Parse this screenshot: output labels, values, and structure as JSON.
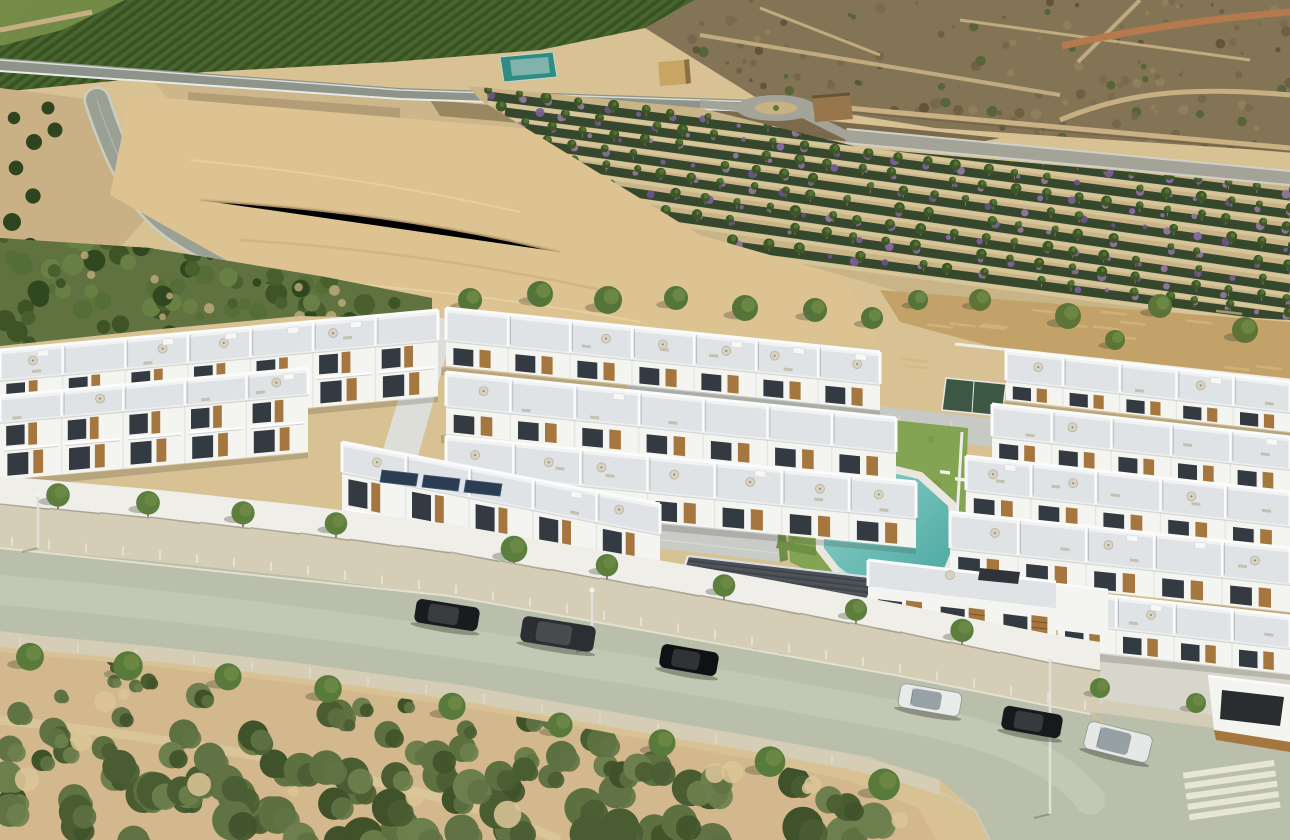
{
  "meta": {
    "kind": "aerial-architectural-render",
    "description": "Aerial 3D render of a new-build white villa residential complex with communal pool, bordered by a tree-lined street with parked cars, scrubland in the foreground, and farmland, a stone bridge and planted nursery rows in the background.",
    "width": 1290,
    "height": 840
  },
  "palette": {
    "ground": "#d8c193",
    "orchard": "#45602c",
    "orchard_row": "#36501f",
    "orchard_light": "#79904a",
    "scrub": "#847456",
    "scrub_dark": "#5e5138",
    "path": "#c6b083",
    "path_red": "#b5794e",
    "asphalt_hwy": "#8e948b",
    "bridge_stone": "#b39d76",
    "arch": "#3e3423",
    "riverbed": "#cdb68a",
    "wet_soil": "#6b5b3e",
    "road": "#9aa194",
    "road_edge": "#d9dcd4",
    "field": "#ddc391",
    "field_line": "#cfb27e",
    "row_green": "#35482d",
    "row_purple": "#8a6aa4",
    "row_purple2": "#6b5288",
    "row_path": "#d8c79b",
    "tree": "#55743a",
    "tree_dark": "#3c5626",
    "tree_light": "#6f8c46",
    "trunk": "#7a6a4e",
    "grove": "#5f7240",
    "meadow": "#c2a269",
    "court": "#3c5844",
    "teal_shed": "#2e8c82",
    "hut": "#c8a563",
    "hut2": "#96764a",
    "wall": "#f4f4f1",
    "roof": "#dfe3e6",
    "parapet": "#fbfbfa",
    "glass": "#333a41",
    "wood": "#a5773f",
    "umbrella": "#d8d2c3",
    "furniture": "#c6c0b0",
    "paving": "#c7cac4",
    "paving_light": "#dcdacf",
    "dark_roof": "#4b5056",
    "lawn": "#83a452",
    "lawn_dark": "#6f9144",
    "pool_deep": "#49a7a1",
    "pool_light": "#90d1ca",
    "pool_rim": "#e9e7df",
    "street": "#b9bfab",
    "street_light": "#cdd2bd",
    "sidewalk": "#d5cdb6",
    "curb": "#e4e0d0",
    "crosswalk": "#eae7d9",
    "sand": "#d2b88c",
    "bush": "#4a5c32",
    "bush2": "#5c7040",
    "bush3": "#3f5229",
    "solar": "#2b3d52",
    "shadow": "rgba(60,62,50,0.3)"
  },
  "scene": {
    "areas": [
      "orchard hillside",
      "highway embankment",
      "stone arch bridge",
      "dry riverbed",
      "northeast scrubland",
      "west access road",
      "sandy dirt field",
      "flower nursery rows",
      "north service road",
      "roundabout",
      "utility structures",
      "dry meadow",
      "padel court",
      "olive grove",
      "residential villa complex",
      "communal lawn",
      "swimming pool",
      "main street",
      "south scrubland"
    ],
    "swimming_pool": {
      "shape": "irregular-angled",
      "water_color": "#49a7a1"
    },
    "bridge_arches": 6,
    "flower_rows": 8,
    "parked_cars": [
      {
        "body": "#191b1f",
        "type": "suv"
      },
      {
        "body": "#2b2f33",
        "type": "sedan"
      },
      {
        "body": "#0f1114",
        "type": "sedan"
      },
      {
        "body": "#e9ebea",
        "type": "hatchback"
      },
      {
        "body": "#17191c",
        "type": "sedan"
      },
      {
        "body": "#e6e8e7",
        "type": "suv"
      }
    ],
    "villa_rows": [
      {
        "cluster": "center-back",
        "units": 7
      },
      {
        "cluster": "east-1",
        "units": 5
      },
      {
        "cluster": "west-back",
        "units": 7
      },
      {
        "cluster": "center-2",
        "units": 7
      },
      {
        "cluster": "east-2",
        "units": 5
      },
      {
        "cluster": "west-front",
        "units": 5
      },
      {
        "cluster": "center-3",
        "units": 7
      },
      {
        "cluster": "east-3",
        "units": 5
      },
      {
        "cluster": "east-4",
        "units": 5
      },
      {
        "cluster": "center-front",
        "units": 5
      },
      {
        "cluster": "east-5",
        "units": 4
      }
    ],
    "street_trees_top": [
      58,
      148,
      243,
      336,
      514,
      607,
      724,
      856,
      962
    ],
    "street_trees_bottom": [
      30,
      128,
      228,
      328,
      452,
      560,
      662,
      770,
      884
    ],
    "road_trees_west": [
      [
        150,
        170
      ],
      [
        187,
        207
      ],
      [
        228,
        240
      ],
      [
        268,
        264
      ],
      [
        306,
        284
      ]
    ],
    "tree_line_north": [
      [
        470,
        300,
        12
      ],
      [
        540,
        294,
        13
      ],
      [
        608,
        300,
        14
      ],
      [
        676,
        298,
        12
      ],
      [
        745,
        308,
        13
      ],
      [
        815,
        310,
        12
      ],
      [
        872,
        318,
        11
      ],
      [
        918,
        300,
        10
      ]
    ],
    "meadow_trees": [
      [
        980,
        300,
        11
      ],
      [
        1068,
        316,
        13
      ],
      [
        1160,
        306,
        12
      ],
      [
        1245,
        330,
        13
      ],
      [
        1115,
        340,
        10
      ]
    ]
  }
}
